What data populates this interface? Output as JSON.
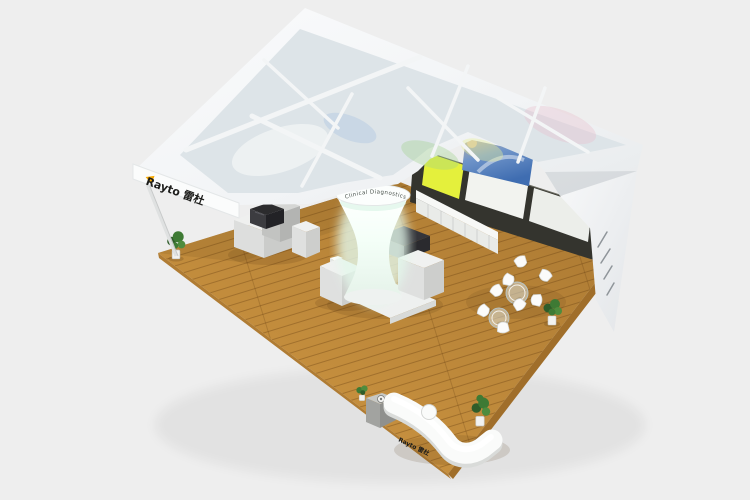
{
  "scene": {
    "type": "3d-render",
    "subject": "exhibition booth design render, aerial isometric view",
    "background_color": "#eeeeee"
  },
  "branding": {
    "fascia_logo": "Rayto 雷杜",
    "counter_logo": "Rayto 雷杜",
    "column_slogan": "Clinical Diagnostics",
    "logo_accent_color": "#f6a800"
  },
  "palette": {
    "canopy_white": "#f5f7f8",
    "skylight_glass": "#dde4e8",
    "floor_wood": "#c8913f",
    "glass_frame": "#34342e",
    "glass_panel_yellow": "#e4f03c",
    "mural_blue": "#4f7cbd",
    "column_glow": "#e3f8eb",
    "counter_white": "#fafbfa",
    "plant_green": "#3e7a34"
  },
  "furniture": {
    "chair_count": 8,
    "glass_table_count": 2,
    "potted_plant_count": 4,
    "display_pedestal_count": 7,
    "analyzer_machine_count": 2
  }
}
